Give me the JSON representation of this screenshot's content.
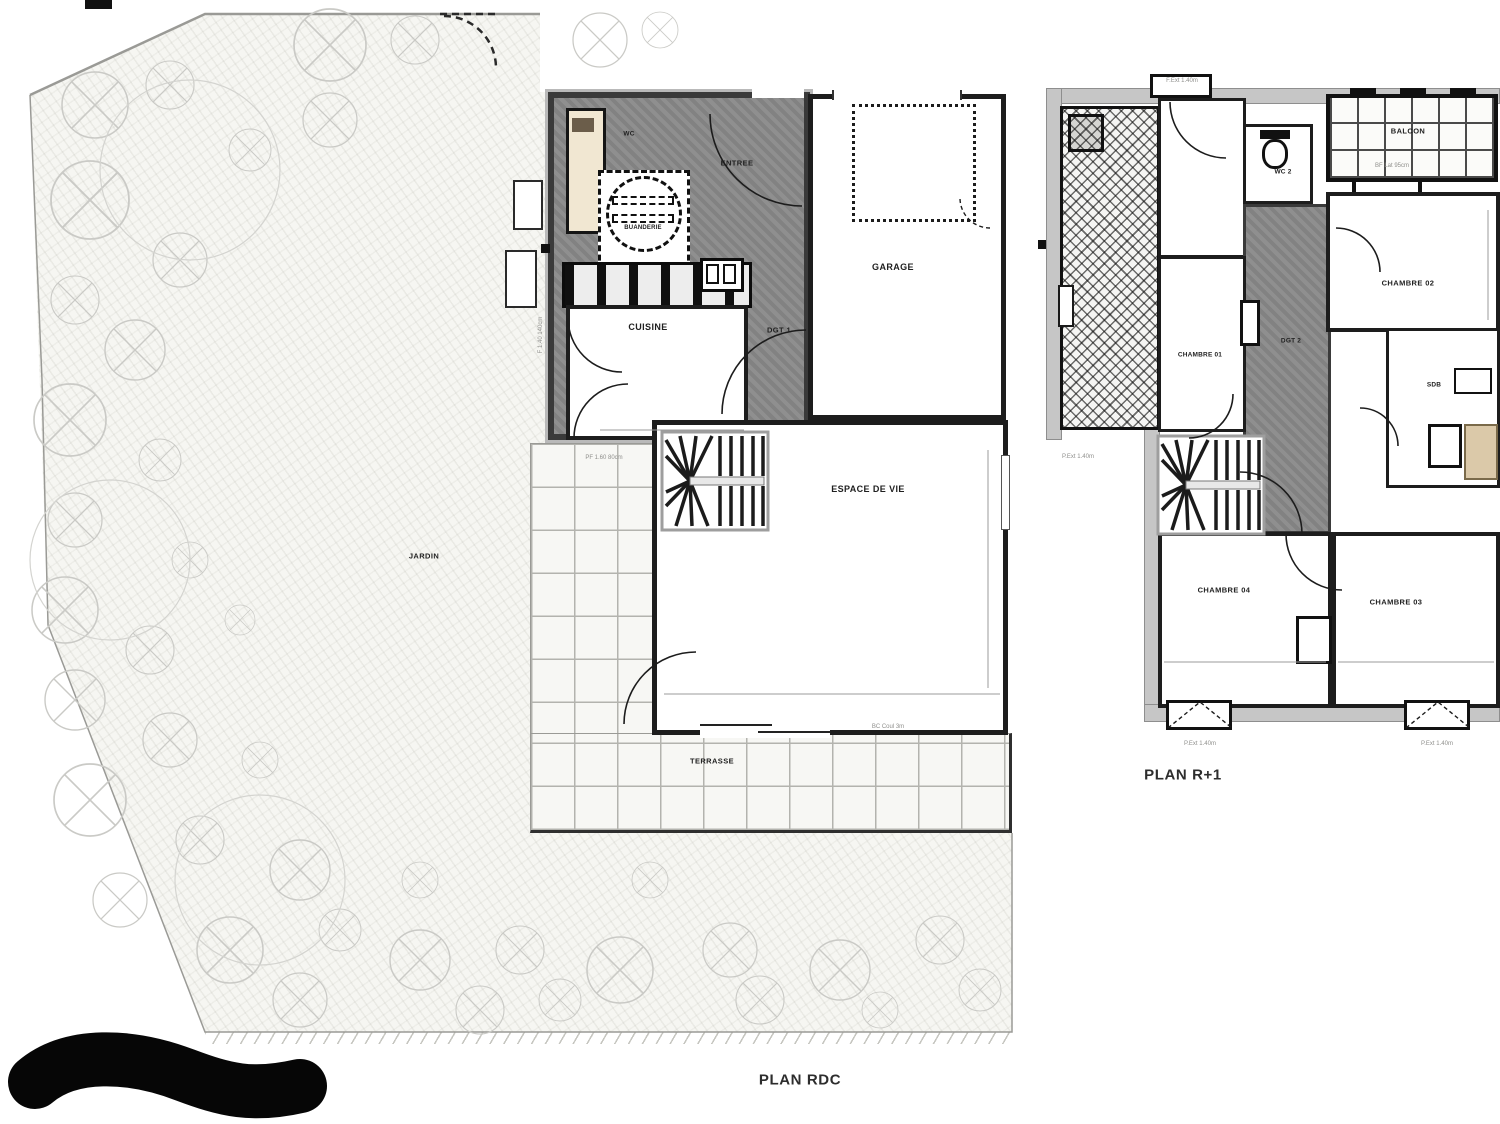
{
  "titles": {
    "rdc": "PLAN RDC",
    "r1": "PLAN R+1"
  },
  "rdc": {
    "rooms": {
      "wc": "WC",
      "entree": "ENTREE",
      "buanderie": "BUANDERIE",
      "cuisine": "CUISINE",
      "dgt1": "DGT 1",
      "garage": "GARAGE",
      "espace_de_vie": "ESPACE DE VIE",
      "jardin": "JARDIN",
      "terrasse": "TERRASSE"
    },
    "annotations": {
      "window_left": "F 1.40 140cm",
      "window_terrace": "PF 1.60 80cm",
      "bay_door": "BC Coul 3m"
    }
  },
  "r1": {
    "rooms": {
      "wc2": "WC 2",
      "balcon": "BALCON",
      "chambre01": "CHAMBRE 01",
      "chambre02": "CHAMBRE 02",
      "dgt2": "DGT 2",
      "sdb": "SDB",
      "chambre04": "CHAMBRE 04",
      "chambre03": "CHAMBRE 03"
    },
    "annotations": {
      "window_top": "F.Ext 1.40m",
      "balcon_note": "BF Lat 95cm",
      "door_left": "P.Ext 1.40m",
      "door_bottom_left": "P.Ext 1.40m",
      "door_bottom_right": "P.Ext 1.40m"
    }
  },
  "colors": {
    "wall_dark": "#3a3a3a",
    "wall_band": "#b9b9b9",
    "circulation_hatch": "#8f8f8f",
    "terrace_line": "#b3b3ae",
    "tree_outline": "#cacac6",
    "label_text": "#1f1f1f",
    "fixture_beige": "#dbc9a9"
  }
}
